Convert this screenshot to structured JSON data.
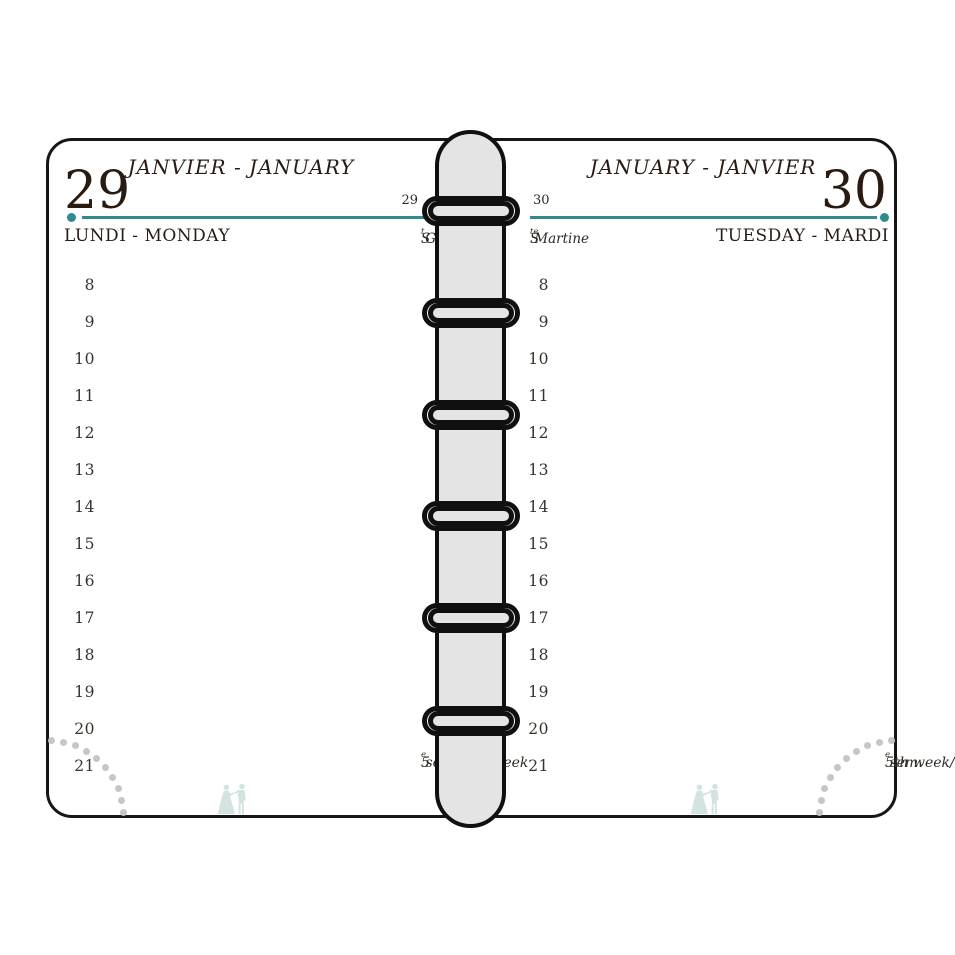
{
  "theme": {
    "accent_teal": "#2e8c8c",
    "ink": "#2a1b12",
    "spine_gray": "#e4e4e4",
    "arc_dot_gray": "#c6c6c6",
    "icon_teal": "#d3e3e2"
  },
  "icons": {
    "bottom_center": "dancing-couple-icon",
    "spine": "binder-rings"
  },
  "pages": [
    {
      "side": "left",
      "month_header": "JANVIER - JANUARY",
      "day_number": "29",
      "day_number_small": "29",
      "day_of_week": "LUNDI - MONDAY",
      "saint": {
        "prefix": "S",
        "sup": "t",
        "name": " Gildas"
      },
      "hours": [
        "8",
        "9",
        "10",
        "11",
        "12",
        "13",
        "14",
        "15",
        "16",
        "17",
        "18",
        "19",
        "20",
        "21"
      ],
      "week": {
        "pre": "5",
        "sup": "e",
        "post": " sem./5th week"
      }
    },
    {
      "side": "right",
      "month_header": "JANUARY - JANVIER",
      "day_number": "30",
      "day_number_small": "30",
      "day_of_week": "TUESDAY - MARDI",
      "saint": {
        "prefix": "S",
        "sup": "te",
        "name": " Martine"
      },
      "hours": [
        "8",
        "9",
        "10",
        "11",
        "12",
        "13",
        "14",
        "15",
        "16",
        "17",
        "18",
        "19",
        "20",
        "21"
      ],
      "week": {
        "pre": "5th week/5",
        "sup": "e",
        "post": " sem."
      }
    }
  ]
}
